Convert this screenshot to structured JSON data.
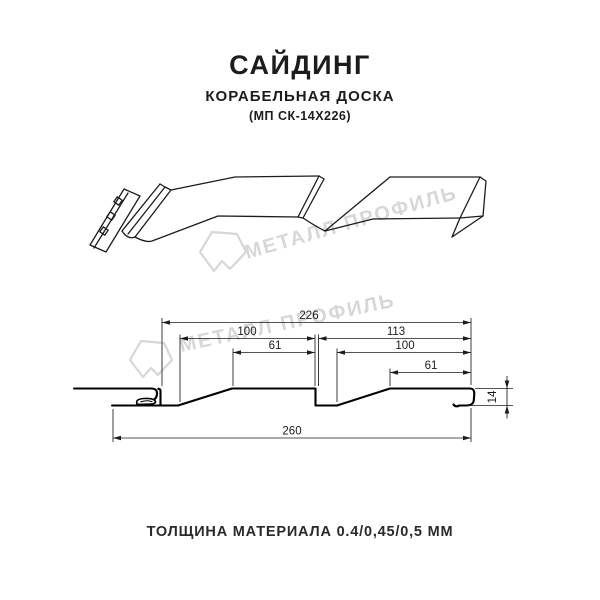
{
  "header": {
    "title": "САЙДИНГ",
    "subtitle": "КОРАБЕЛЬНАЯ ДОСКА",
    "model_code": "(МП СК-14Х226)"
  },
  "watermark": {
    "text": "МЕТАЛЛ ПРОФИЛЬ",
    "color": "#d7d7d7"
  },
  "section": {
    "description": "cross-section of siding profile with dimension lines",
    "dims": {
      "module_width": "226",
      "left_pitch": "100",
      "left_flat": "61",
      "right_step": "113",
      "right_pitch": "100",
      "right_flat": "61",
      "total_width": "260",
      "height": "14"
    }
  },
  "footer": {
    "thickness": "ТОЛЩИНА МАТЕРИАЛА 0.4/0,45/0,5 ММ"
  },
  "colors": {
    "line": "#1c1c1c",
    "watermark": "#d7d7d7",
    "background": "#ffffff"
  }
}
